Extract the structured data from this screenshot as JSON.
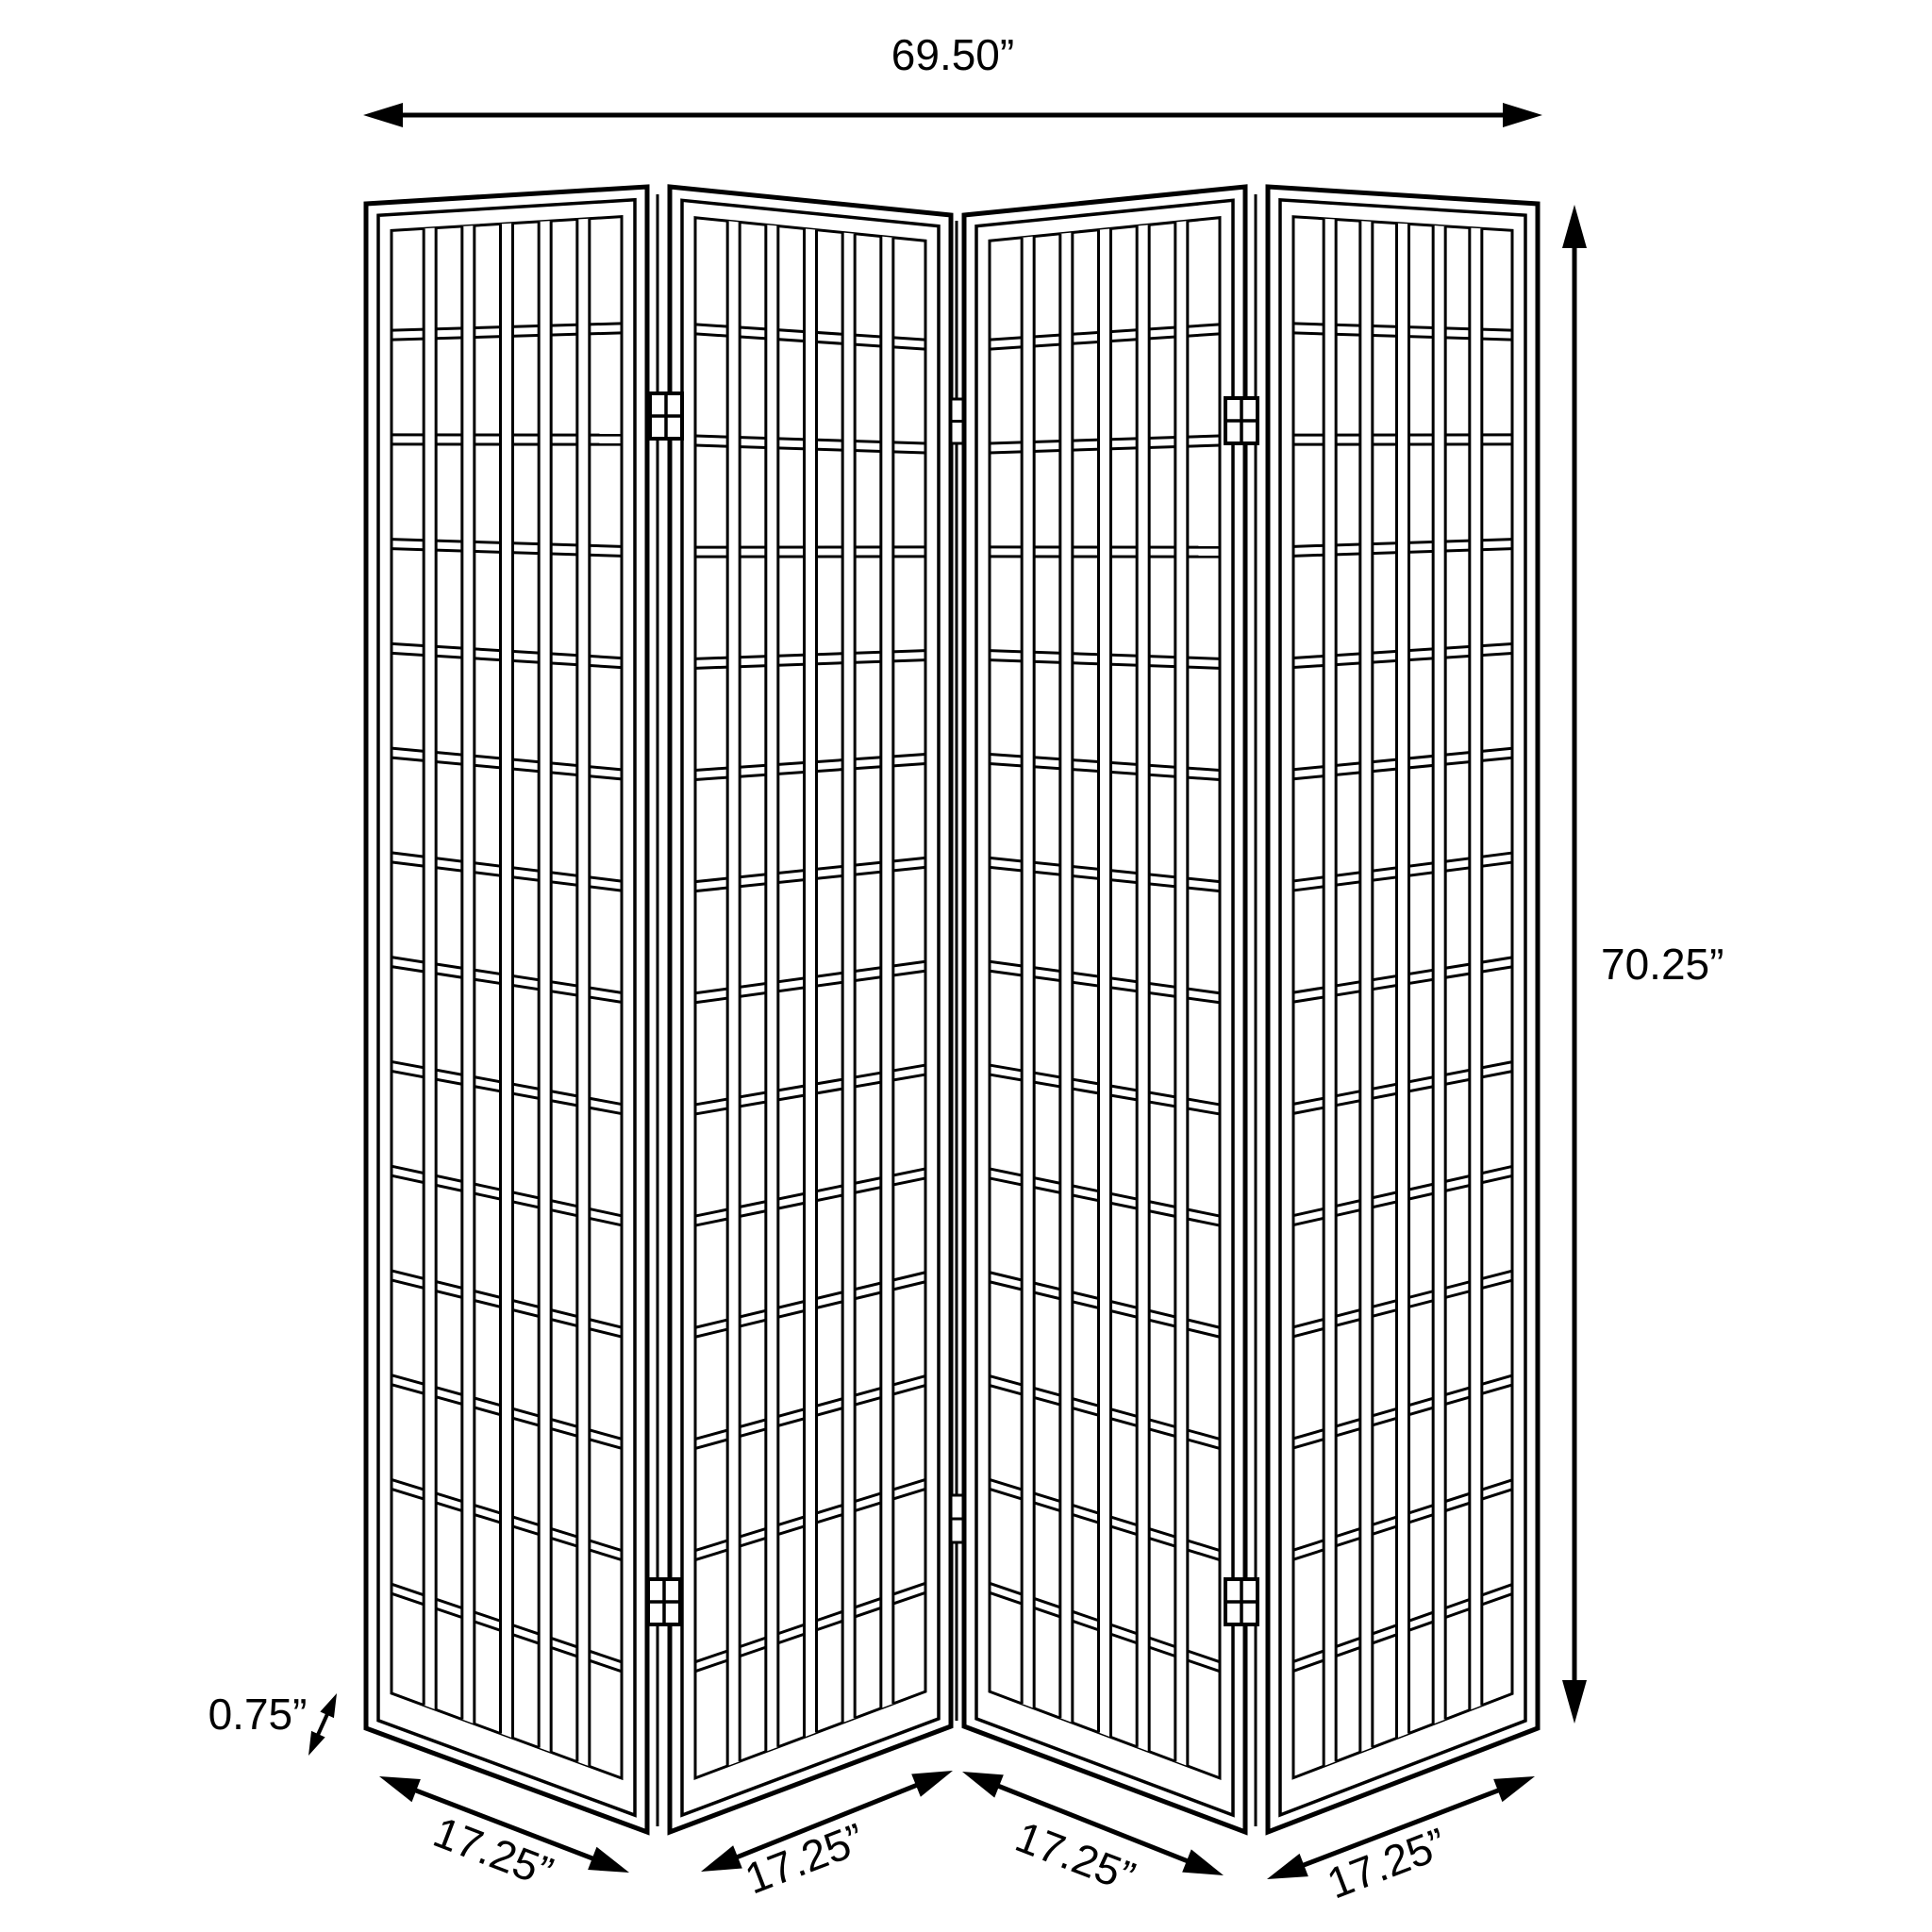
{
  "diagram": {
    "type": "product-dimension-diagram",
    "subject": "four-panel folding shoji room divider screen",
    "panel_count": 4,
    "grid_columns_per_panel": 6,
    "grid_rows_per_panel": 14
  },
  "dimensions": {
    "overall_width": "69.50”",
    "overall_height": "70.25”",
    "panel_thickness": "0.75”",
    "panel_widths": [
      "17.25”",
      "17.25”",
      "17.25”",
      "17.25”"
    ]
  },
  "colors": {
    "line": "#000000",
    "background": "#ffffff",
    "text": "#000000"
  }
}
